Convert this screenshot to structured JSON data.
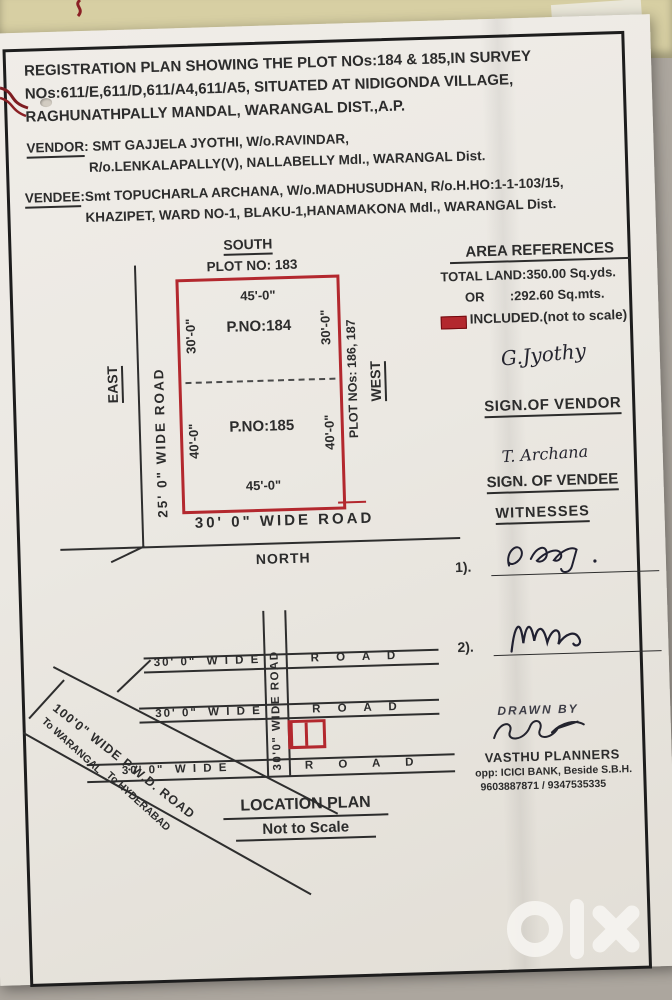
{
  "title": {
    "l1": "REGISTRATION PLAN SHOWING THE PLOT NOs:184 & 185,IN SURVEY",
    "l2": "NOs:611/E,611/D,611/A4,611/A5, SITUATED AT NIDIGONDA VILLAGE,",
    "l3": "RAGHUNATHPALLY  MANDAL,  WARANGAL DIST.,A.P."
  },
  "vendor": {
    "label": "VENDOR",
    "l1": ": SMT GAJJELA  JYOTHI,   W/o.RAVINDAR,",
    "l2": "R/o.LENKALAPALLY(V),   NALLABELLY Mdl.,  WARANGAL Dist."
  },
  "vendee": {
    "label": "VENDEE",
    "l1": ":Smt TOPUCHARLA  ARCHANA,  W/o.MADHUSUDHAN,  R/o.H.HO:1-1-103/15,",
    "l2": "KHAZIPET, WARD NO-1, BLAKU-1,HANAMAKONA Mdl., WARANGAL Dist."
  },
  "plot_plan": {
    "south": "SOUTH",
    "adjacent_top": "PLOT NO: 183",
    "dim_top": "45'-0\"",
    "dim_bottom": "45'-0\"",
    "p1": {
      "name": "P.NO:184",
      "left": "30'-0\"",
      "right": "30'-0\""
    },
    "p2": {
      "name": "P.NO:185",
      "left": "40'-0\"",
      "right": "40'-0\""
    },
    "east": "EAST",
    "left_road": "25' 0\" WIDE ROAD",
    "right_plots": "PLOT NOs: 186, 187",
    "west": "WEST",
    "bottom_road": "30' 0\" WIDE ROAD",
    "north": "NORTH"
  },
  "area": {
    "heading": "AREA REFERENCES",
    "total": "TOTAL LAND:350.00 Sq.yds.",
    "or_line": "OR       :292.60 Sq.mts.",
    "included": "INCLUDED.(not to scale)"
  },
  "signs": {
    "vendor_sig": "G.Jyothy",
    "vendor_caption": "SIGN.OF VENDOR",
    "vendee_sig": "T. Archana",
    "vendee_caption": "SIGN. OF VENDEE"
  },
  "witnesses": {
    "heading": "WITNESSES",
    "items": [
      "1).",
      "2)."
    ]
  },
  "loc": {
    "v_road": "30'0\" WIDE ROAD",
    "wide": "30' 0\"  W I D E",
    "road": "R O A D",
    "pwd": "100'0\" WIDE P.W.D. ROAD",
    "to_warangal": "To WARANGAL",
    "to_hyderabad": "To HYDERABAD",
    "title": "LOCATION PLAN",
    "subtitle": "Not to Scale"
  },
  "drawn": {
    "label": "DRAWN BY",
    "firm": "VASTHU PLANNERS",
    "address": "opp: ICICI BANK, Beside S.B.H.",
    "phones": "9603887871 / 9347535335"
  },
  "watermark": {
    "label": "olx"
  },
  "colors": {
    "plot_red": "#b3282e",
    "ink": "#2c2c2c",
    "paper": "#ebe8e2"
  }
}
